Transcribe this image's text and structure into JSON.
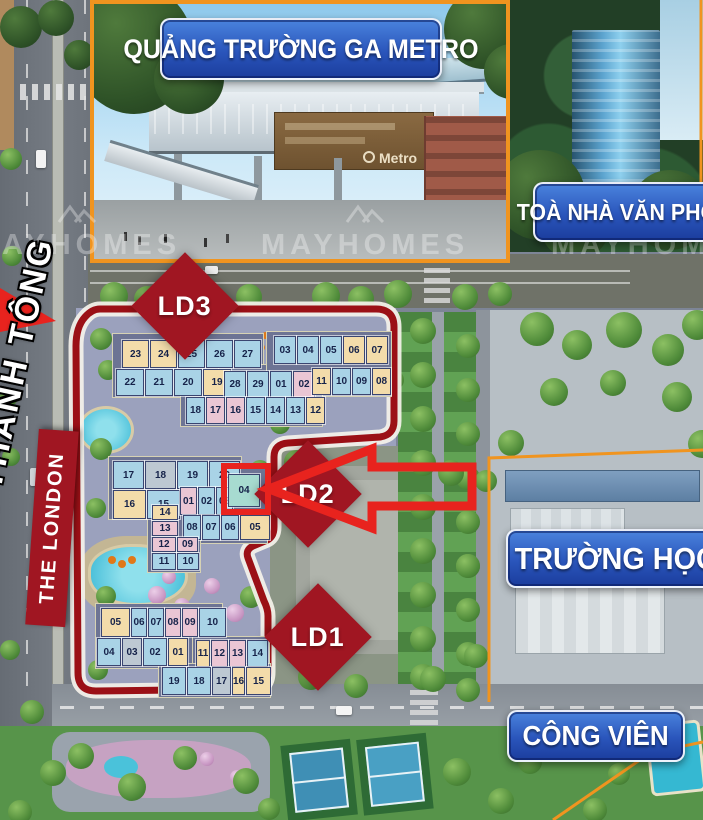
{
  "palette": {
    "boundary_red": "#9b1016",
    "arrow_red": "#e8231e",
    "diamond_red": "#a01622",
    "label_blue_top": "#4a83dd",
    "label_blue_bottom": "#1b3d9d",
    "photo_border_orange": "#f0941f",
    "unit_cream": "#f3dcaa",
    "unit_blue": "#a9d3e6",
    "unit_pink": "#eac6d4",
    "unit_grey": "#bdc8d2",
    "unit_teal": "#a7dbd0"
  },
  "photo": {
    "metro_label": "QUẢNG TRƯỜNG GA METRO",
    "metro_sign": "Metro"
  },
  "labels": {
    "office": "TOÀ NHÀ VĂN PHÒNG",
    "school": "TRƯỜNG HỌC",
    "park": "CÔNG VIÊN",
    "project": "THE LONDON",
    "street": "ĐƯỜNG LÊ THANH TÔNG"
  },
  "watermark": {
    "text": "MAYHOMES",
    "positions": [
      {
        "x": -38,
        "y": 204
      },
      {
        "x": 250,
        "y": 204
      },
      {
        "x": 540,
        "y": 204
      }
    ]
  },
  "markers": [
    {
      "id": "LD3",
      "x": 185,
      "y": 306
    },
    {
      "id": "LD2",
      "x": 308,
      "y": 494
    },
    {
      "id": "LD1",
      "x": 318,
      "y": 637
    }
  ],
  "highlight": {
    "block": "MID",
    "unit": "04"
  },
  "blocks": [
    {
      "block": "LD3",
      "x": 122,
      "y": 340,
      "cw": 27,
      "ch": 28,
      "cells": [
        {
          "n": "23",
          "c": "cream"
        },
        {
          "n": "24",
          "c": "cream"
        },
        {
          "n": "25",
          "c": "blue"
        },
        {
          "n": "26",
          "c": "blue"
        },
        {
          "n": "27",
          "c": "blue"
        }
      ]
    },
    {
      "block": "LD3",
      "x": 274,
      "y": 336,
      "cw": 22,
      "ch": 28,
      "cells": [
        {
          "n": "03",
          "c": "blue"
        },
        {
          "n": "04",
          "c": "blue"
        },
        {
          "n": "05",
          "c": "blue"
        },
        {
          "n": "06",
          "c": "cream"
        },
        {
          "n": "07",
          "c": "cream"
        }
      ]
    },
    {
      "block": "LD3",
      "x": 116,
      "y": 369,
      "cw": 28,
      "ch": 27,
      "cells": [
        {
          "n": "22",
          "c": "blue"
        },
        {
          "n": "21",
          "c": "blue"
        },
        {
          "n": "20",
          "c": "blue"
        },
        {
          "n": "19",
          "c": "cream"
        }
      ]
    },
    {
      "block": "LD3",
      "x": 224,
      "y": 371,
      "cw": 22,
      "ch": 27,
      "cells": [
        {
          "n": "28",
          "c": "blue"
        },
        {
          "n": "29",
          "c": "blue"
        },
        {
          "n": "01",
          "c": "blue"
        },
        {
          "n": "02",
          "c": "pink"
        }
      ]
    },
    {
      "block": "LD3",
      "x": 312,
      "y": 368,
      "cw": 19,
      "ch": 27,
      "cells": [
        {
          "n": "11",
          "c": "cream"
        },
        {
          "n": "10",
          "c": "blue"
        },
        {
          "n": "09",
          "c": "blue"
        },
        {
          "n": "08",
          "c": "cream"
        }
      ]
    },
    {
      "block": "LD3",
      "x": 186,
      "y": 397,
      "cw": 19,
      "ch": 27,
      "cells": [
        {
          "n": "18",
          "c": "blue"
        },
        {
          "n": "17",
          "c": "pink"
        },
        {
          "n": "16",
          "c": "pink"
        },
        {
          "n": "15",
          "c": "blue"
        },
        {
          "n": "14",
          "c": "blue"
        },
        {
          "n": "13",
          "c": "blue"
        },
        {
          "n": "12",
          "c": "cream"
        }
      ]
    },
    {
      "block": "MID",
      "x": 113,
      "y": 461,
      "cw": 31,
      "ch": 28,
      "cells": [
        {
          "n": "17",
          "c": "blue"
        },
        {
          "n": "18",
          "c": "grey"
        },
        {
          "n": "19",
          "c": "blue"
        },
        {
          "n": "20",
          "c": "blue"
        }
      ]
    },
    {
      "block": "MID",
      "x": 113,
      "y": 490,
      "cw": 33,
      "ch": 29,
      "cells": [
        {
          "n": "16",
          "c": "cream"
        },
        {
          "n": "15",
          "c": "blue"
        }
      ]
    },
    {
      "block": "MID",
      "x": 180,
      "y": 487,
      "cw": 17,
      "ch": 28,
      "cells": [
        {
          "n": "01",
          "c": "pink"
        },
        {
          "n": "02",
          "c": "blue"
        },
        {
          "n": "03",
          "c": "blue"
        }
      ]
    },
    {
      "block": "MID",
      "x": 228,
      "y": 474,
      "cw": 32,
      "ch": 33,
      "cells": [
        {
          "n": "04",
          "c": "teal"
        }
      ]
    },
    {
      "block": "MID",
      "x": 183,
      "y": 515,
      "cw": 18,
      "ch": 25,
      "cells": [
        {
          "n": "08",
          "c": "blue"
        },
        {
          "n": "07",
          "c": "blue"
        },
        {
          "n": "06",
          "c": "blue"
        },
        {
          "n": "05",
          "c": "cream",
          "w": 30
        }
      ]
    },
    {
      "block": "MID",
      "x": 152,
      "y": 505,
      "cw": 26,
      "ch": 15,
      "cells": [
        {
          "n": "14",
          "c": "cream"
        }
      ]
    },
    {
      "block": "MID",
      "x": 152,
      "y": 521,
      "cw": 26,
      "ch": 15,
      "cells": [
        {
          "n": "13",
          "c": "pink"
        }
      ]
    },
    {
      "block": "MID",
      "x": 152,
      "y": 537,
      "cw": 24,
      "ch": 15,
      "cells": [
        {
          "n": "12",
          "c": "pink"
        },
        {
          "n": "09",
          "c": "pink",
          "w": 21
        }
      ]
    },
    {
      "block": "MID",
      "x": 152,
      "y": 553,
      "cw": 24,
      "ch": 17,
      "cells": [
        {
          "n": "11",
          "c": "blue"
        },
        {
          "n": "10",
          "c": "blue",
          "w": 22
        }
      ]
    },
    {
      "block": "LD1",
      "x": 101,
      "y": 608,
      "cw": 16,
      "ch": 29,
      "cells": [
        {
          "n": "05",
          "c": "cream",
          "w": 29
        },
        {
          "n": "06",
          "c": "blue"
        },
        {
          "n": "07",
          "c": "blue"
        },
        {
          "n": "08",
          "c": "pink"
        },
        {
          "n": "09",
          "c": "pink"
        },
        {
          "n": "10",
          "c": "blue",
          "w": 27
        }
      ]
    },
    {
      "block": "LD1",
      "x": 97,
      "y": 638,
      "cw": 24,
      "ch": 28,
      "cells": [
        {
          "n": "04",
          "c": "blue"
        },
        {
          "n": "03",
          "c": "grey",
          "w": 20
        },
        {
          "n": "02",
          "c": "blue"
        },
        {
          "n": "01",
          "c": "cream",
          "w": 20
        }
      ]
    },
    {
      "block": "LD1",
      "x": 196,
      "y": 640,
      "cw": 14,
      "ch": 27,
      "cells": [
        {
          "n": "11",
          "c": "cream"
        },
        {
          "n": "12",
          "c": "pink",
          "w": 17
        },
        {
          "n": "13",
          "c": "pink",
          "w": 17
        },
        {
          "n": "14",
          "c": "blue",
          "w": 21
        }
      ]
    },
    {
      "block": "LD1",
      "x": 162,
      "y": 667,
      "cw": 24,
      "ch": 28,
      "cells": [
        {
          "n": "19",
          "c": "blue"
        },
        {
          "n": "18",
          "c": "blue"
        },
        {
          "n": "17",
          "c": "grey",
          "w": 19
        },
        {
          "n": "16",
          "c": "cream",
          "w": 13
        },
        {
          "n": "15",
          "c": "cream",
          "w": 25
        }
      ]
    }
  ]
}
